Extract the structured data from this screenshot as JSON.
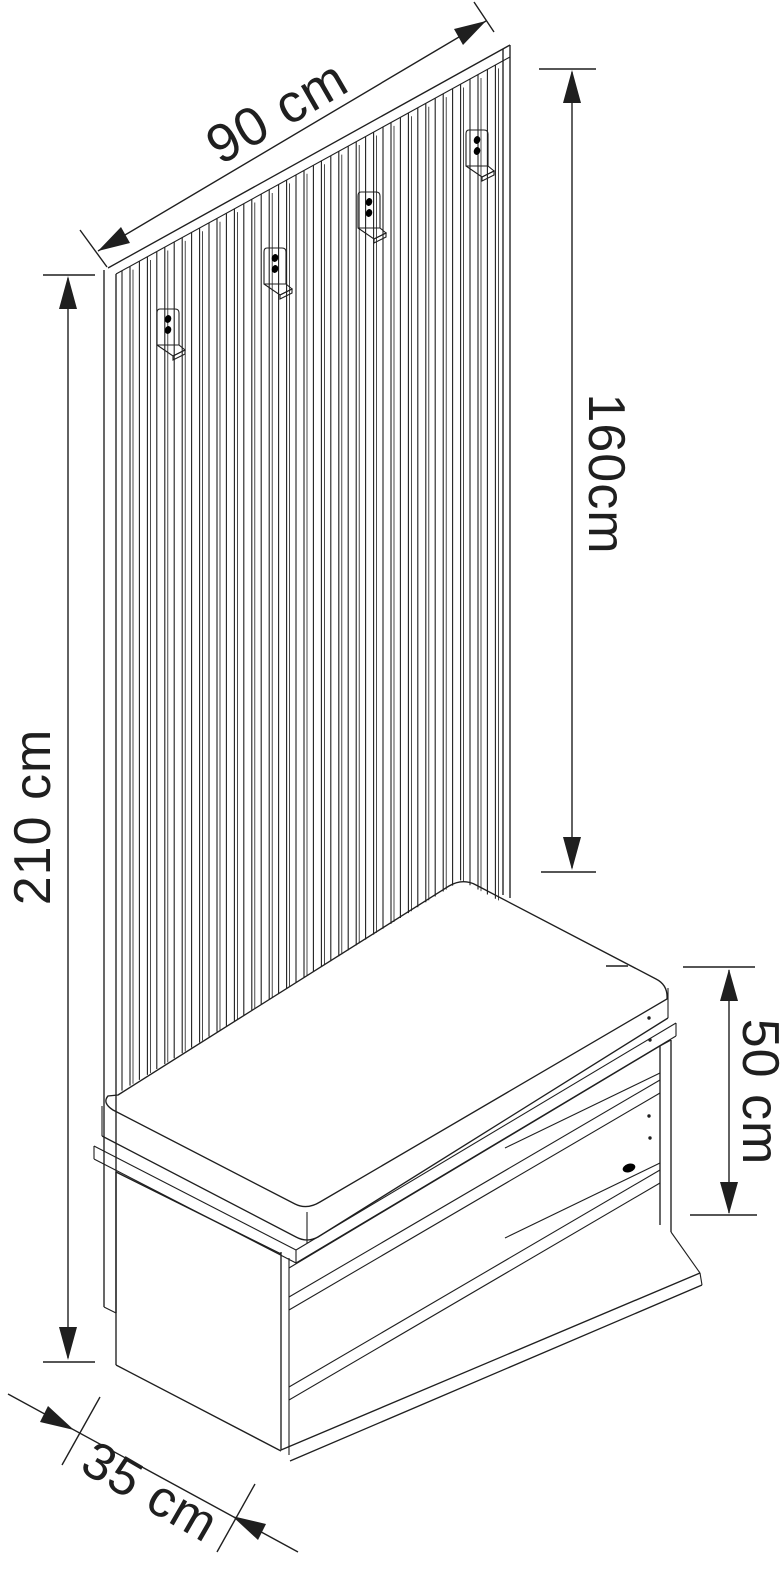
{
  "figure": {
    "type": "technical-line-drawing",
    "subject": "hallway coat-rack slat panel with 4 hooks and shoe storage bench",
    "hook_count": 4,
    "slat_count": 22,
    "shelf_count": 2
  },
  "dimensions": {
    "panel_width": {
      "label": "90 cm",
      "value": 90,
      "unit": "cm"
    },
    "panel_height": {
      "label": "160cm",
      "value": 160,
      "unit": "cm"
    },
    "total_height": {
      "label": "210 cm",
      "value": 210,
      "unit": "cm"
    },
    "bench_height": {
      "label": "50 cm",
      "value": 50,
      "unit": "cm"
    },
    "bench_depth": {
      "label": "35 cm",
      "value": 35,
      "unit": "cm"
    }
  },
  "colors": {
    "line": "#1f1f1f",
    "background": "#ffffff"
  }
}
